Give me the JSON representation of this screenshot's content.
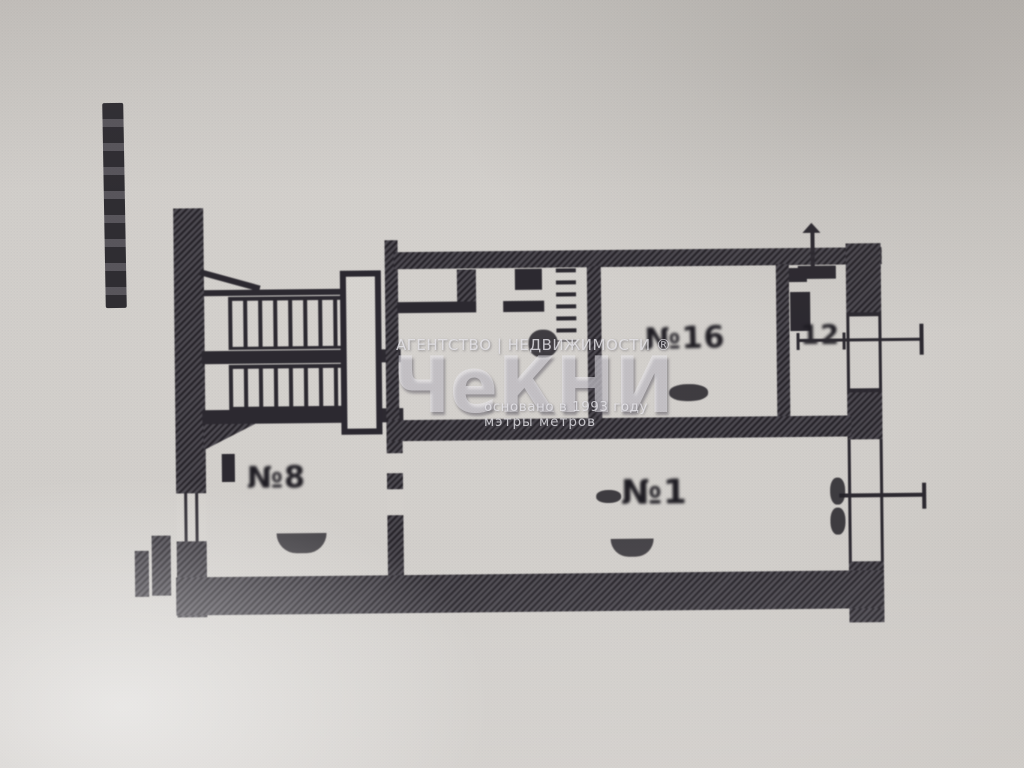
{
  "watermark": {
    "agency_line": "АГЕНТСТВО | НЕДВИЖИМОСТИ ®",
    "logo_text": "ЧеКНИ",
    "founded_line": "основано в 1993 году",
    "tagline": "мэтры метров"
  },
  "plan_labels": {
    "room_top_center": "№16",
    "room_top_right": "12",
    "room_bottom_left": "№8",
    "room_bottom_main": "№1"
  },
  "colors": {
    "paper": "#d2cfcb",
    "ink": "#2c2930",
    "watermark": "#e9e7ee"
  }
}
